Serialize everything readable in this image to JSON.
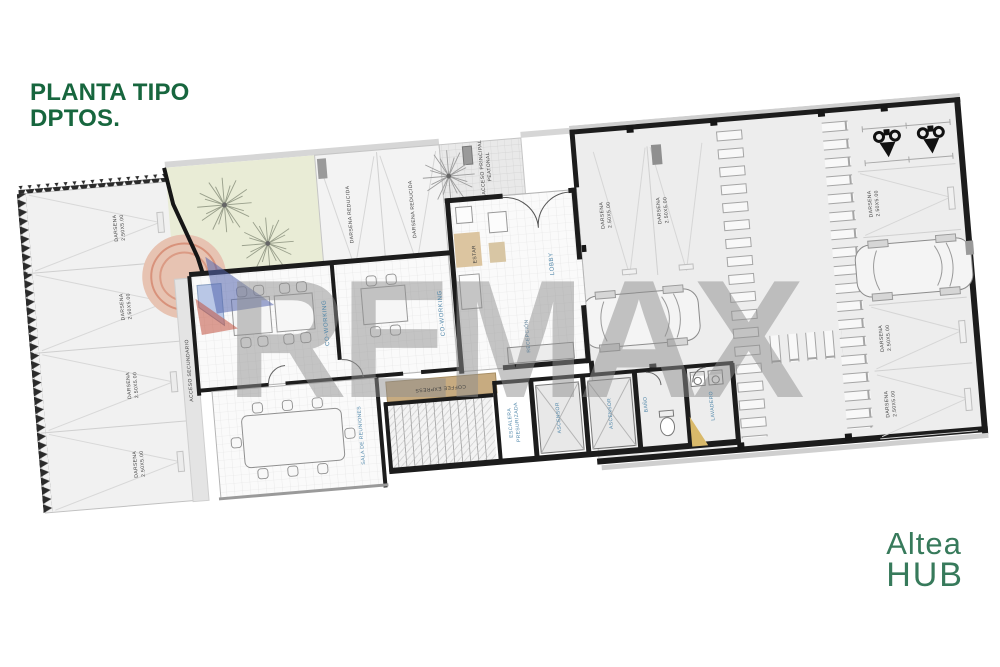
{
  "header": {
    "title_line1": "PLANTA TIPO",
    "title_line2": "DPTOS."
  },
  "brand": {
    "line1": "Altea",
    "line2": "HUB"
  },
  "watermark": {
    "text": "REMAX",
    "balloon_blue": "#5566ae",
    "balloon_red": "#c2523f"
  },
  "plan": {
    "labels": {
      "darsena": "DARSENA\n2.50X5.00",
      "darsena_reducida": "DARSENA REDUCIDA",
      "coworking": "CO-WORKING",
      "acceso_secundario": "ACCESO SECUNDARIO",
      "acceso_principal": "ACCESO PRINCIPAL\nPEATONAL",
      "sala_reuniones": "SALA DE REUNIONES",
      "coffee_express": "COFFEE EXPRESS",
      "lobby": "LOBBY",
      "estar": "ESTAR",
      "recepcion": "RECEPCIÓN",
      "escalera": "ESCALERA\nPRESURIZADA",
      "ascensor": "ASCENSOR",
      "bano": "BAÑO",
      "lavadero": "LAVADERO"
    },
    "colors": {
      "title_green": "#17663e",
      "brand_green": "#377a5b",
      "label_blue": "#4f86a9",
      "garden": "#e9ecd6",
      "coffee_tan": "#c7ab80",
      "wall": "#1c1c1c",
      "watermark_gray": "#8f8f8f"
    }
  }
}
